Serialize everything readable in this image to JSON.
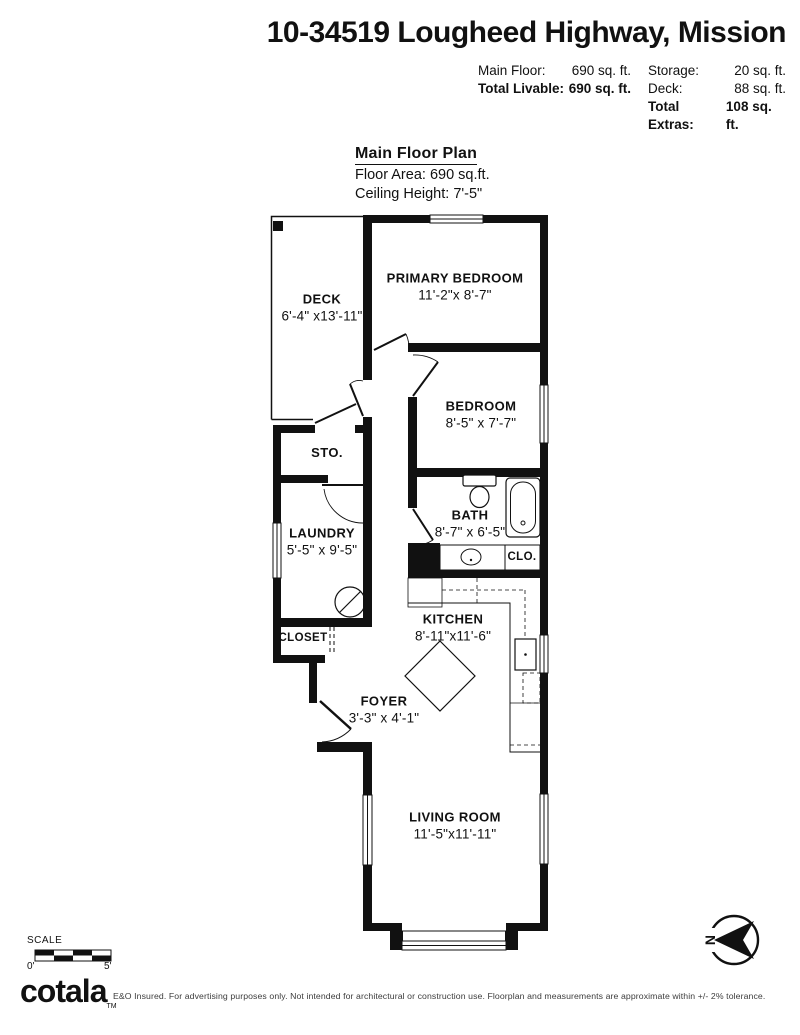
{
  "header": {
    "title": "10-34519 Lougheed Highway, Mission",
    "stats": {
      "main_floor_label": "Main Floor:",
      "main_floor_value": "690 sq. ft.",
      "total_livable_label": "Total Livable:",
      "total_livable_value": "690 sq. ft.",
      "storage_label": "Storage:",
      "storage_value": "20 sq. ft.",
      "deck_label": "Deck:",
      "deck_value": "88 sq. ft.",
      "total_extras_label": "Total Extras:",
      "total_extras_value": "108 sq. ft."
    }
  },
  "plan_info": {
    "heading": "Main Floor Plan",
    "floor_area": "Floor Area: 690 sq.ft.",
    "ceiling_height": "Ceiling Height: 7'-5\""
  },
  "rooms": {
    "deck": {
      "name": "DECK",
      "dims": "6'-4\" x13'-11\""
    },
    "primary_bedroom": {
      "name": "PRIMARY BEDROOM",
      "dims": "11'-2\"x 8'-7\""
    },
    "bedroom": {
      "name": "BEDROOM",
      "dims": "8'-5\" x 7'-7\""
    },
    "storage": {
      "name": "STO."
    },
    "laundry": {
      "name": "LAUNDRY",
      "dims": "5'-5\" x 9'-5\""
    },
    "bath": {
      "name": "BATH",
      "dims": "8'-7\" x 6'-5\""
    },
    "closet_small": {
      "name": "CLO."
    },
    "kitchen": {
      "name": "KITCHEN",
      "dims": "8'-11\"x11'-6\""
    },
    "closet": {
      "name": "CLOSET"
    },
    "foyer": {
      "name": "FOYER",
      "dims": "3'-3\" x 4'-1\""
    },
    "living_room": {
      "name": "LIVING ROOM",
      "dims": "11'-5\"x11'-11\""
    }
  },
  "footer": {
    "scale_label": "SCALE",
    "scale_start": "0'",
    "scale_end": "5'",
    "logo_text": "cotala",
    "logo_tm": "TM",
    "disclaimer": "E&O Insured. For advertising purposes only. Not intended for architectural or construction use. Floorplan and measurements are approximate within +/- 2% tolerance.",
    "north_label": "N"
  },
  "colors": {
    "ink": "#111111",
    "background": "#ffffff"
  }
}
